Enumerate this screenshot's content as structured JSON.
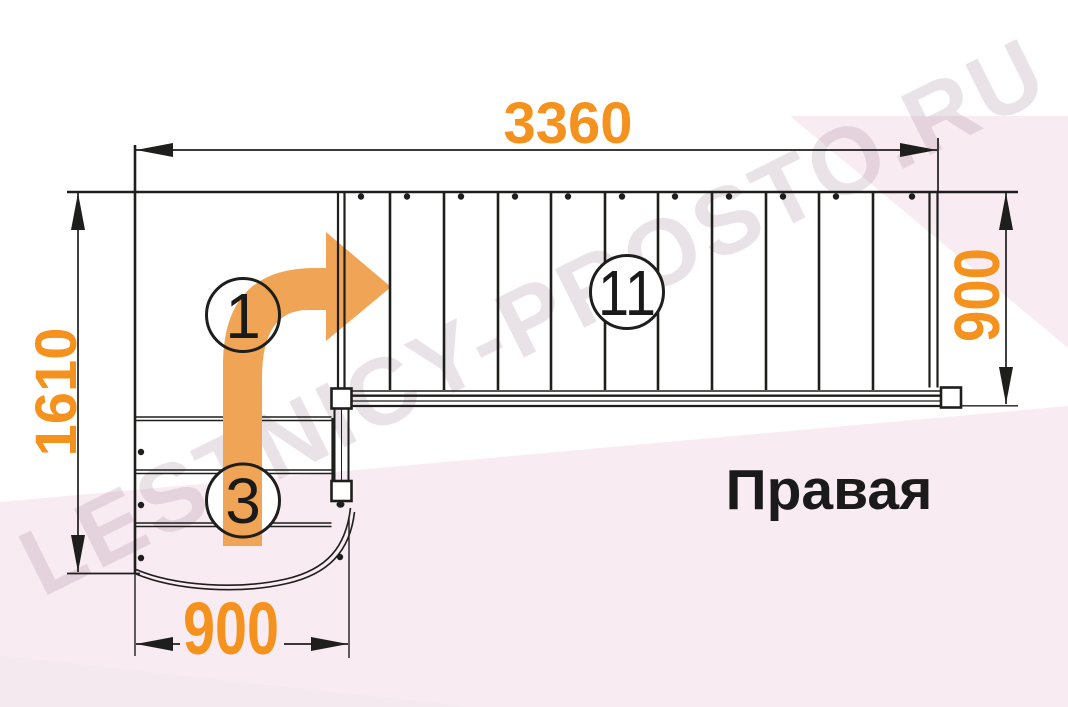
{
  "watermark": {
    "text": "LESTNICY-PROSTO.RU"
  },
  "orientation_label": "Правая",
  "dimensions": {
    "top": "3360",
    "left": "1610",
    "right": "900",
    "bottom": "900"
  },
  "step_markers": [
    {
      "label": "1"
    },
    {
      "label": "3"
    },
    {
      "label": "11"
    }
  ],
  "colors": {
    "dimension_text": "#F5921E",
    "flow_arrow": "#F0A455",
    "line": "#1E1E1C",
    "background_pink": "#F8EBF1",
    "background_pink_light": "#F4E9EF",
    "watermark": "#96788C",
    "label_text": "#1A1A1A"
  }
}
